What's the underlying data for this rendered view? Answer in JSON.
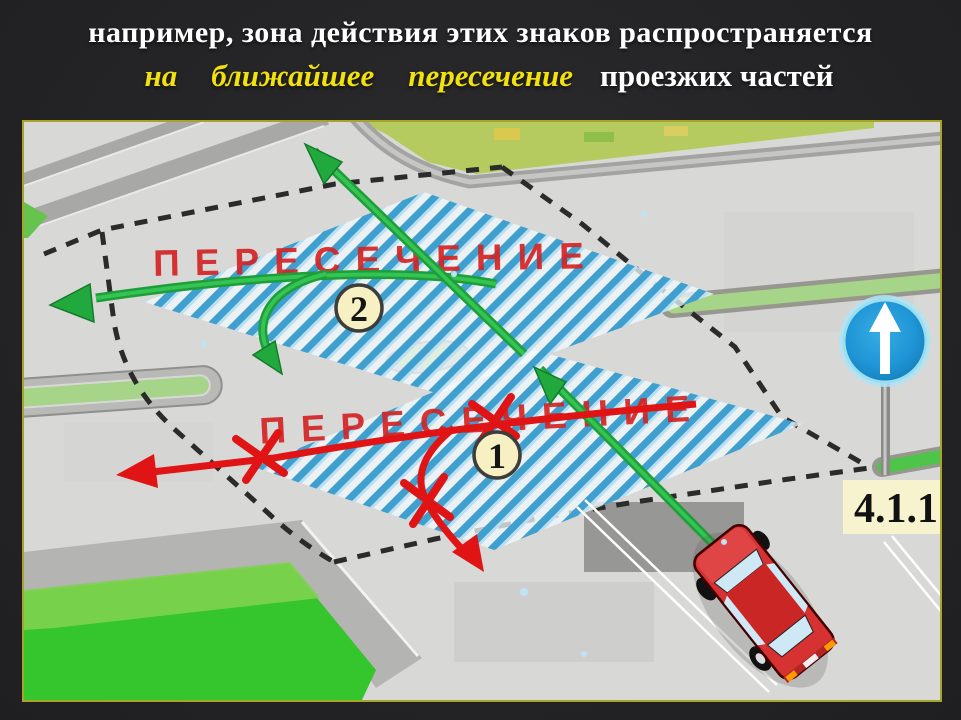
{
  "slide": {
    "title_line1": "например, зона действия этих знаков распространяется",
    "title_line2_highlight": [
      "на",
      "ближайшее",
      "пересечение"
    ],
    "title_line2_rest": "проезжих частей",
    "colors": {
      "background": "#242426",
      "title_text": "#ffffff",
      "highlight_yellow": "#f2e10c",
      "frame_border": "#a8a428"
    }
  },
  "diagram": {
    "zone_upper": {
      "label": "ПЕРЕСЕЧЕНИЕ",
      "number": "2"
    },
    "zone_lower": {
      "label": "ПЕРЕСЕЧЕНИЕ",
      "number": "1"
    },
    "sign": {
      "code_label": "4.1.1",
      "meaning": "movement straight ahead",
      "icon": "up-arrow"
    },
    "colors": {
      "allowed_path_green": "#1fa93c",
      "prohibited_path_red": "#e01414",
      "hatch_blue": "#3f9fce",
      "zone_label_red": "#d42424",
      "road_gray": "#d8d8d6",
      "grass_green": "#35c52d",
      "sign_blue": "#1e95d5"
    }
  }
}
